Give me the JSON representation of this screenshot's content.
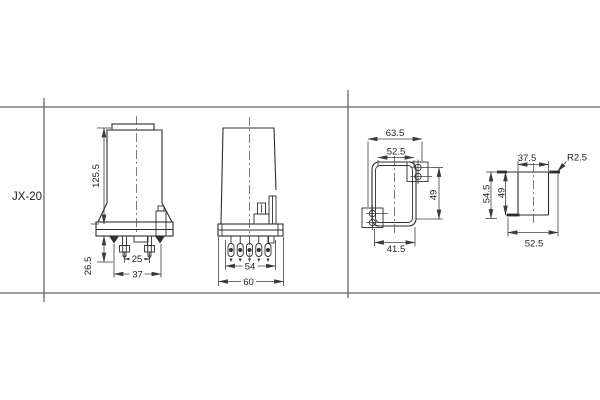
{
  "row_label": "JX-20",
  "colors": {
    "background": "#ffffff",
    "ink": "#2e2e2e",
    "dimension_lines": "#3f3f3f",
    "frame_lines": "#646464",
    "text": "#1f1f1f"
  },
  "views": {
    "front": {
      "dims": {
        "height": "125.5",
        "terminal_height": "26.5",
        "stud_spacing": "25",
        "base_width": "37"
      }
    },
    "side": {
      "dims": {
        "pin_span": "54",
        "overall_width": "60"
      }
    },
    "panel_cutout": {
      "dims": {
        "outer_width": "63.5",
        "inner_width": "52.5",
        "height": "49",
        "bottom_width": "41.5"
      }
    },
    "panel_side": {
      "dims": {
        "top_width": "37.5",
        "corner_radius": "R2.5",
        "outer_height": "54.5",
        "inner_height": "49",
        "bottom_width": "52.5"
      }
    }
  }
}
